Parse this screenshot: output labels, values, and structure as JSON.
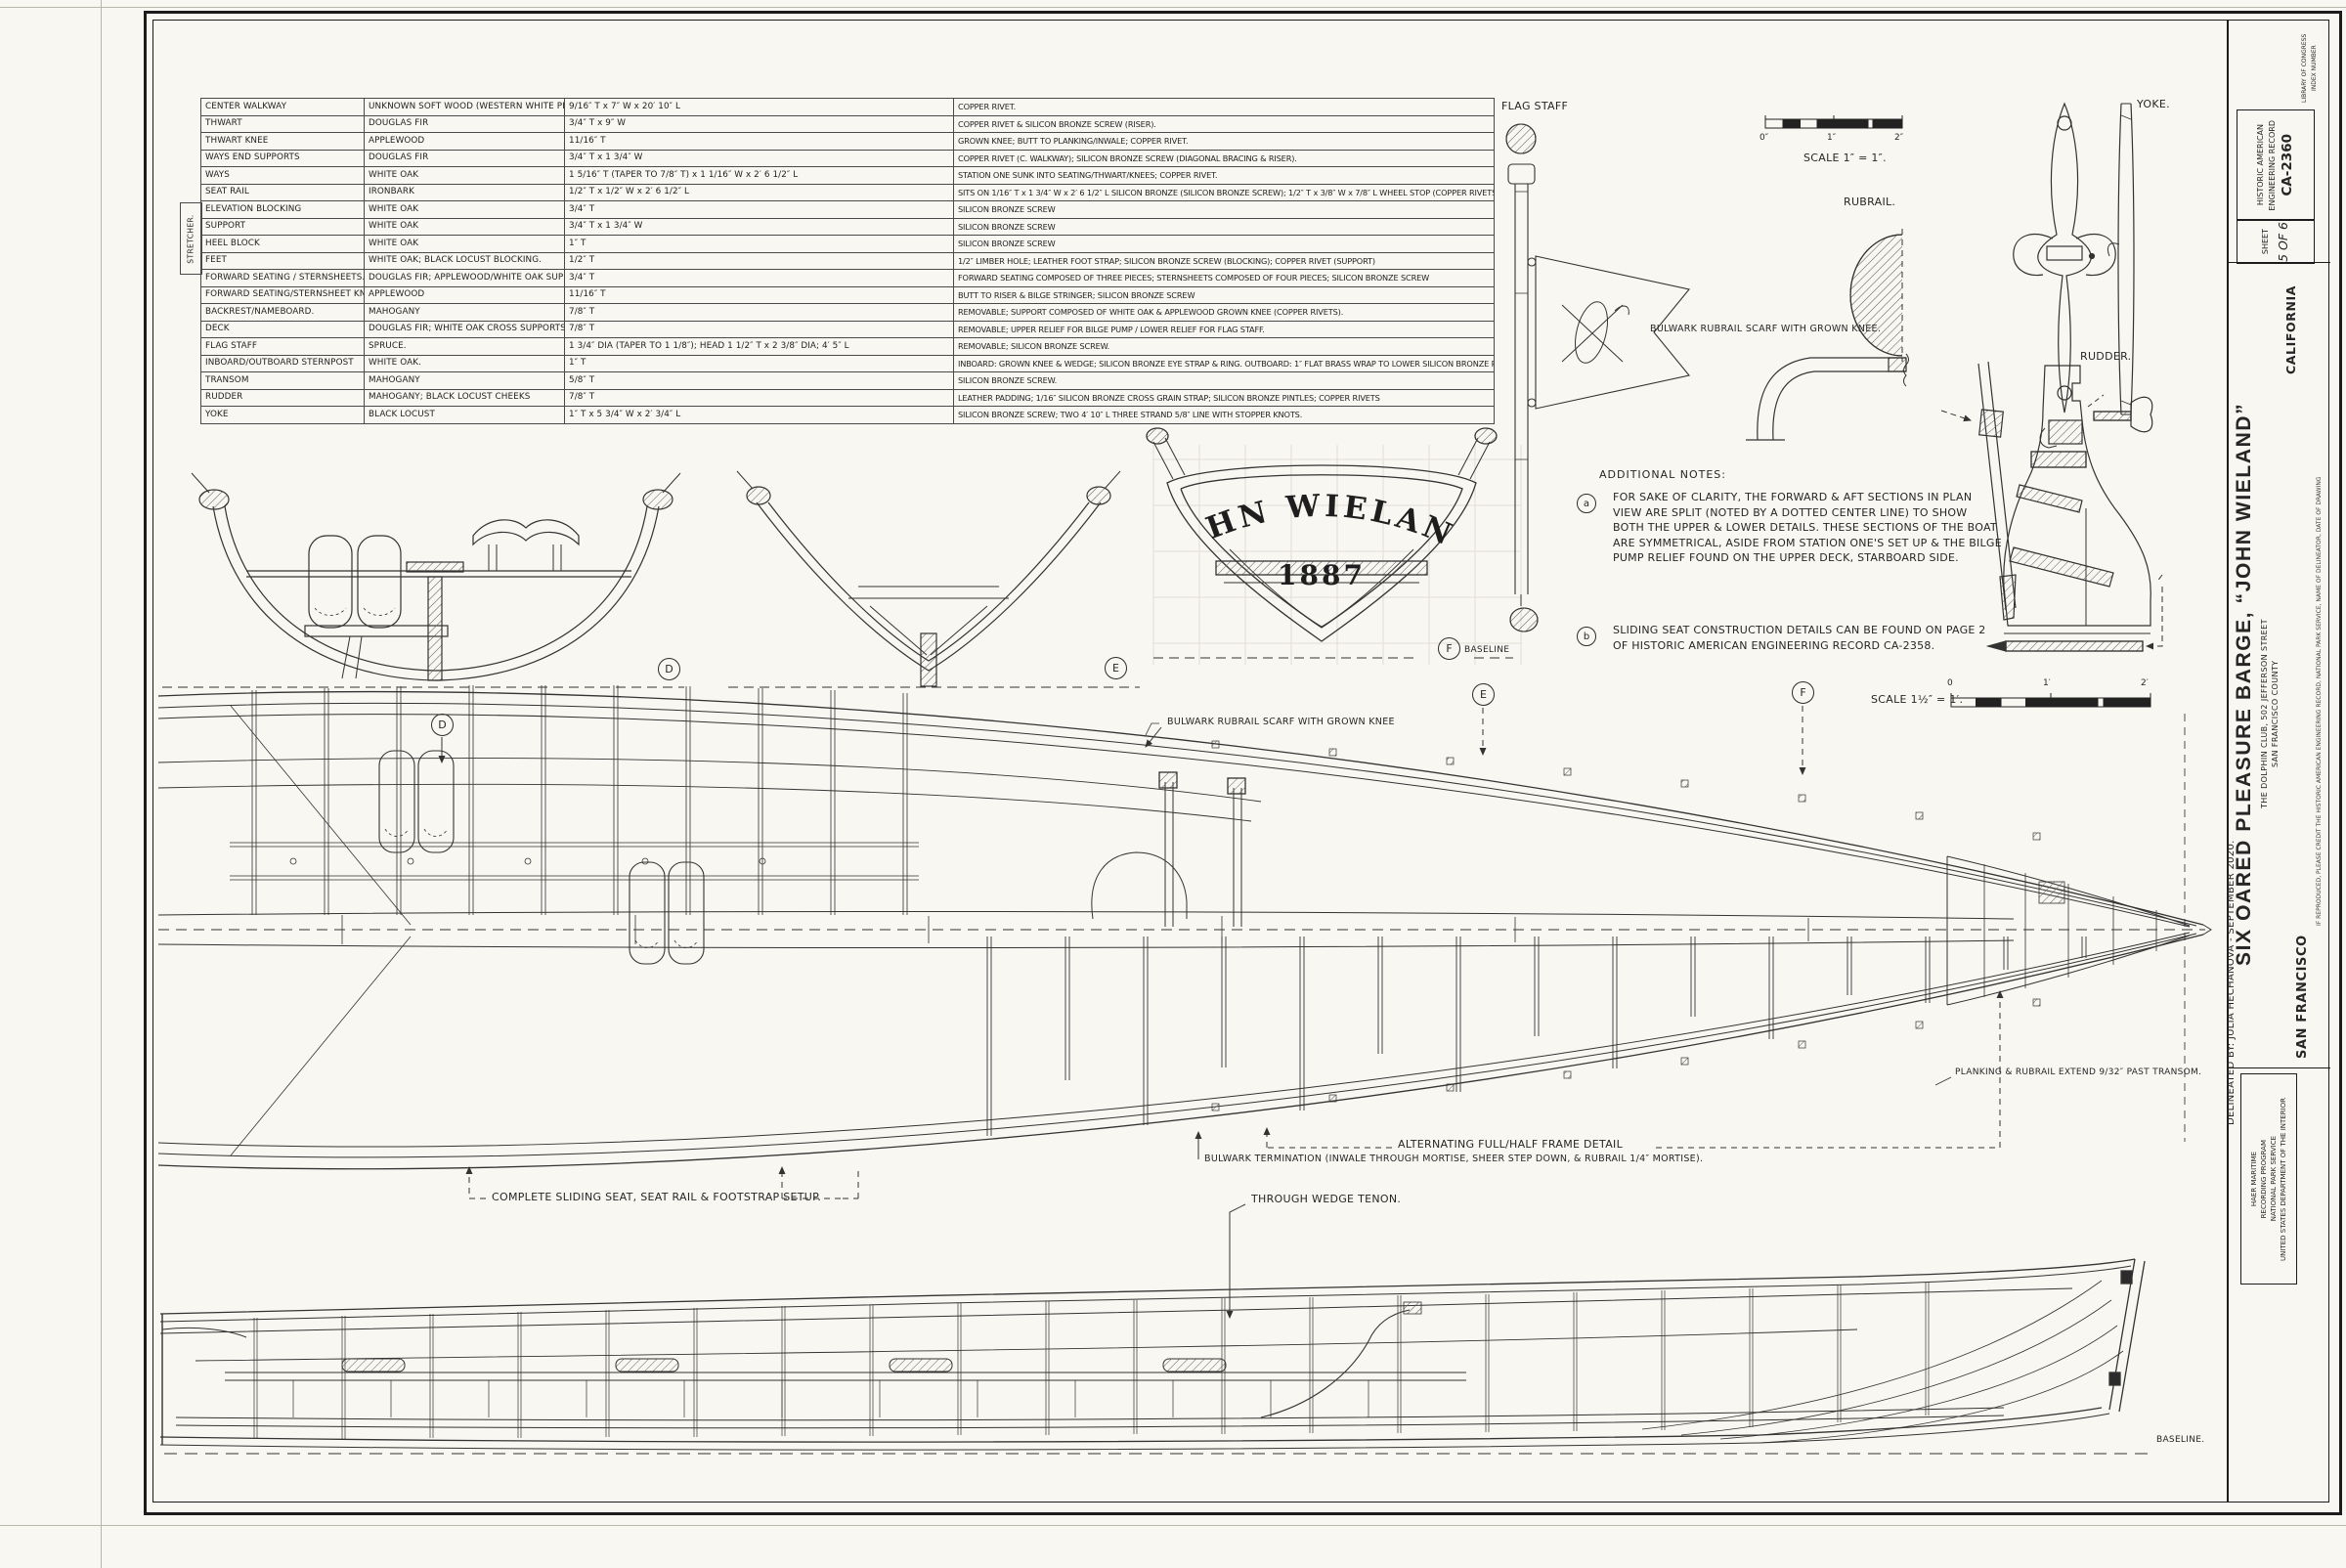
{
  "palette": {
    "paper": "#f8f7f2",
    "ink": "#262626",
    "line": "#333333"
  },
  "table": {
    "group_label": "STRETCHER.",
    "rows": [
      {
        "part": "CENTER WALKWAY",
        "material": "UNKNOWN SOFT WOOD (WESTERN WHITE PINE?)",
        "dims": "9/16″ T x 7″ W x 20′ 10″ L",
        "fastening": "COPPER RIVET."
      },
      {
        "part": "THWART",
        "material": "DOUGLAS FIR",
        "dims": "3/4″ T x 9″ W",
        "fastening": "COPPER RIVET & SILICON BRONZE SCREW (RISER)."
      },
      {
        "part": "THWART KNEE",
        "material": "APPLEWOOD",
        "dims": "11/16″ T",
        "fastening": "GROWN KNEE; BUTT TO PLANKING/INWALE; COPPER RIVET."
      },
      {
        "part": "WAYS END SUPPORTS",
        "material": "DOUGLAS FIR",
        "dims": "3/4″ T x 1 3/4″ W",
        "fastening": "COPPER RIVET (C. WALKWAY); SILICON BRONZE SCREW (DIAGONAL BRACING & RISER)."
      },
      {
        "part": "WAYS",
        "material": "WHITE OAK",
        "dims": "1 5/16″ T (TAPER TO 7/8″ T) x 1 1/16″ W x 2′ 6 1/2″ L",
        "fastening": "STATION ONE SUNK INTO SEATING/THWART/KNEES; COPPER RIVET."
      },
      {
        "part": "SEAT RAIL",
        "material": "IRONBARK",
        "dims": "1/2″ T x 1/2″ W x 2′ 6 1/2″ L",
        "fastening": "SITS ON 1/16″ T x 1 3/4″ W x 2′ 6 1/2″ L SILICON BRONZE (SILICON BRONZE SCREW); 1/2″ T x 3/8″ W x 7/8″ L WHEEL STOP (COPPER RIVETS)."
      },
      {
        "part": "ELEVATION BLOCKING",
        "material": "WHITE OAK",
        "dims": "3/4″ T",
        "fastening": "SILICON BRONZE SCREW"
      },
      {
        "part": "SUPPORT",
        "material": "WHITE OAK",
        "dims": "3/4″ T x 1 3/4″ W",
        "fastening": "SILICON BRONZE SCREW"
      },
      {
        "part": "HEEL BLOCK",
        "material": "WHITE OAK",
        "dims": "1″ T",
        "fastening": "SILICON BRONZE SCREW"
      },
      {
        "part": "FEET",
        "material": "WHITE OAK; BLACK LOCUST BLOCKING.",
        "dims": "1/2″ T",
        "fastening": "1/2″ LIMBER HOLE; LEATHER FOOT STRAP; SILICON BRONZE SCREW (BLOCKING); COPPER RIVET (SUPPORT)"
      },
      {
        "part": "FORWARD SEATING / STERNSHEETS.",
        "material": "DOUGLAS FIR; APPLEWOOD/WHITE OAK SUPPORTS",
        "dims": "3/4″ T",
        "fastening": "FORWARD SEATING COMPOSED OF THREE PIECES; STERNSHEETS COMPOSED OF FOUR PIECES; SILICON BRONZE SCREW"
      },
      {
        "part": "FORWARD SEATING/STERNSHEET KNEE",
        "material": "APPLEWOOD",
        "dims": "11/16″ T",
        "fastening": "BUTT TO RISER & BILGE STRINGER; SILICON BRONZE SCREW"
      },
      {
        "part": "BACKREST/NAMEBOARD.",
        "material": "MAHOGANY",
        "dims": "7/8″ T",
        "fastening": "REMOVABLE; SUPPORT COMPOSED OF WHITE OAK & APPLEWOOD GROWN KNEE (COPPER RIVETS)."
      },
      {
        "part": "DECK",
        "material": "DOUGLAS FIR; WHITE OAK CROSS SUPPORTS",
        "dims": "7/8″ T",
        "fastening": "REMOVABLE; UPPER RELIEF FOR BILGE PUMP / LOWER RELIEF FOR FLAG STAFF."
      },
      {
        "part": "FLAG STAFF",
        "material": "SPRUCE.",
        "dims": "1 3/4″ DIA (TAPER TO 1 1/8″); HEAD 1 1/2″ T x 2 3/8″ DIA; 4′ 5″ L",
        "fastening": "REMOVABLE; SILICON BRONZE SCREW."
      },
      {
        "part": "INBOARD/OUTBOARD STERNPOST",
        "material": "WHITE OAK.",
        "dims": "1″ T",
        "fastening": "INBOARD: GROWN KNEE & WEDGE; SILICON BRONZE EYE STRAP & RING. OUTBOARD: 1″ FLAT BRASS WRAP TO LOWER SILICON BRONZE RUDDER GUDGEON."
      },
      {
        "part": "TRANSOM",
        "material": "MAHOGANY",
        "dims": "5/8″ T",
        "fastening": "SILICON BRONZE SCREW."
      },
      {
        "part": "RUDDER",
        "material": "MAHOGANY; BLACK LOCUST CHEEKS",
        "dims": "7/8″ T",
        "fastening": "LEATHER PADDING; 1/16″ SILICON BRONZE CROSS GRAIN STRAP; SILICON BRONZE PINTLES; COPPER RIVETS"
      },
      {
        "part": "YOKE",
        "material": "BLACK LOCUST",
        "dims": "1″ T x 5 3/4″ W x 2′ 3/4″ L",
        "fastening": "SILICON BRONZE SCREW; TWO 4′ 10″ L THREE STRAND 5/8″ LINE WITH STOPPER KNOTS."
      }
    ]
  },
  "details": {
    "flag_staff_label": "FLAG STAFF",
    "rubrail_label": "RUBRAIL.",
    "scarf_label": "BULWARK RUBRAIL SCARF WITH GROWN KNEE.",
    "yoke_label": "YOKE.",
    "rudder_label": "RUDDER.",
    "scale_full": {
      "label": "SCALE 1″ = 1″.",
      "ticks": [
        "0″",
        "1″",
        "2″"
      ]
    }
  },
  "notes": {
    "title": "ADDITIONAL NOTES:",
    "items": [
      {
        "key": "a",
        "text": "FOR SAKE OF CLARITY, THE FORWARD & AFT SECTIONS IN PLAN VIEW ARE SPLIT (NOTED BY A DOTTED CENTER LINE) TO SHOW BOTH THE UPPER & LOWER DETAILS. THESE SECTIONS OF THE BOAT ARE SYMMETRICAL, ASIDE FROM STATION ONE'S SET UP & THE BILGE PUMP RELIEF FOUND ON THE UPPER DECK, STARBOARD SIDE."
      },
      {
        "key": "b",
        "text": "SLIDING SEAT CONSTRUCTION DETAILS CAN BE FOUND ON PAGE 2 OF HISTORIC AMERICAN ENGINEERING RECORD CA-2358."
      }
    ]
  },
  "sections": {
    "d": "D",
    "e": "E",
    "f": "F",
    "baseline_label": "BASELINE",
    "transom_name": "JOHN WIELAND",
    "transom_year": "1887"
  },
  "plan": {
    "markers": {
      "d": "D",
      "e": "E",
      "f": "F"
    },
    "scale": {
      "label": "SCALE 1½″ = 1′.",
      "ticks": [
        "0",
        "1′",
        "2′"
      ]
    },
    "callouts": {
      "scarf": "BULWARK RUBRAIL SCARF WITH GROWN KNEE",
      "sliding_seat": "COMPLETE SLIDING SEAT, SEAT RAIL & FOOTSTRAP SETUP.",
      "bulwark_termination": "BULWARK TERMINATION (INWALE THROUGH MORTISE, SHEER STEP DOWN, & RUBRAIL 1/4″ MORTISE).",
      "wedge_tenon": "THROUGH WEDGE TENON.",
      "frame_detail": "ALTERNATING FULL/HALF FRAME DETAIL",
      "planking": "PLANKING & RUBRAIL EXTEND 9/32″ PAST TRANSOM."
    }
  },
  "profile": {
    "baseline_label": "BASELINE."
  },
  "titleblock": {
    "delineated_by": "DELINEATED BY: JULIA HECHANOVA - SEPTEMBER 2020.",
    "agency_lines": [
      "HAER MARITIME",
      "RECORDING PROGRAM",
      "NATIONAL PARK SERVICE",
      "UNITED STATES DEPARTMENT OF THE INTERIOR"
    ],
    "city": "SAN FRANCISCO",
    "title": "SIX OARED PLEASURE BARGE, “JOHN WIELAND”",
    "subtitle1": "THE DOLPHIN CLUB, 502 JEFFERSON STREET",
    "subtitle2": "SAN FRANCISCO COUNTY",
    "state": "CALIFORNIA",
    "sheet_label": "SHEET",
    "sheet_number": "5 OF 6",
    "record_line1": "HISTORIC AMERICAN",
    "record_line2": "ENGINEERING RECORD",
    "record_number": "CA-2360",
    "loc_line1": "LIBRARY OF CONGRESS",
    "loc_line2": "INDEX NUMBER",
    "credit": "IF REPRODUCED, PLEASE CREDIT THE HISTORIC AMERICAN ENGINEERING RECORD, NATIONAL PARK SERVICE, NAME OF DELINEATOR, DATE OF DRAWING"
  }
}
